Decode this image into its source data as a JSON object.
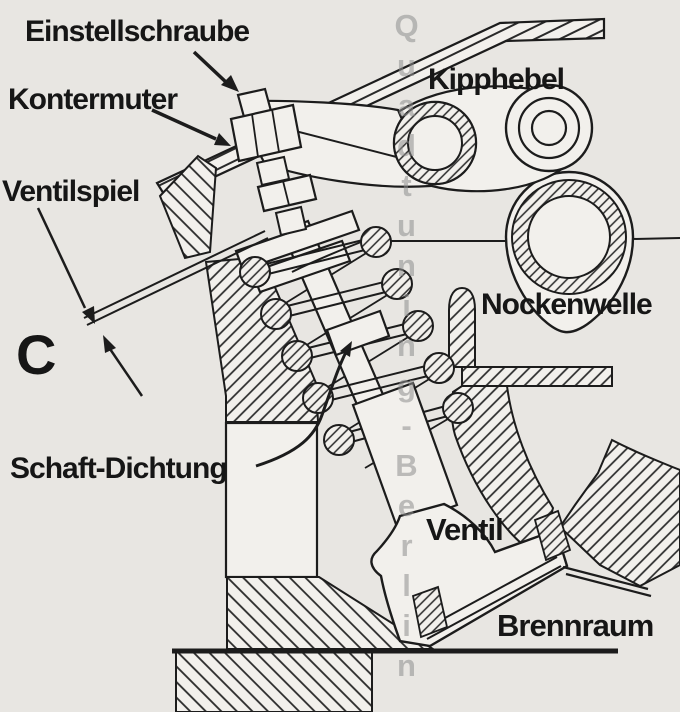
{
  "figure": {
    "section_letter": "C",
    "labels": {
      "einstellschraube": "Einstellschraube",
      "kontermuter": "Kontermuter",
      "ventilspiel": "Ventilspiel",
      "kipphebel": "Kipphebel",
      "nockenwelle": "Nockenwelle",
      "schaft_dichtung": "Schaft-Dichtung",
      "ventil": "Ventil",
      "brennraum": "Brennraum"
    },
    "watermark": "Quadtuning-Berlin",
    "colors": {
      "background": "#e8e6e2",
      "paper": "#f2f0ec",
      "ink": "#1c1c1c",
      "watermark": "#8f8f8f"
    }
  }
}
